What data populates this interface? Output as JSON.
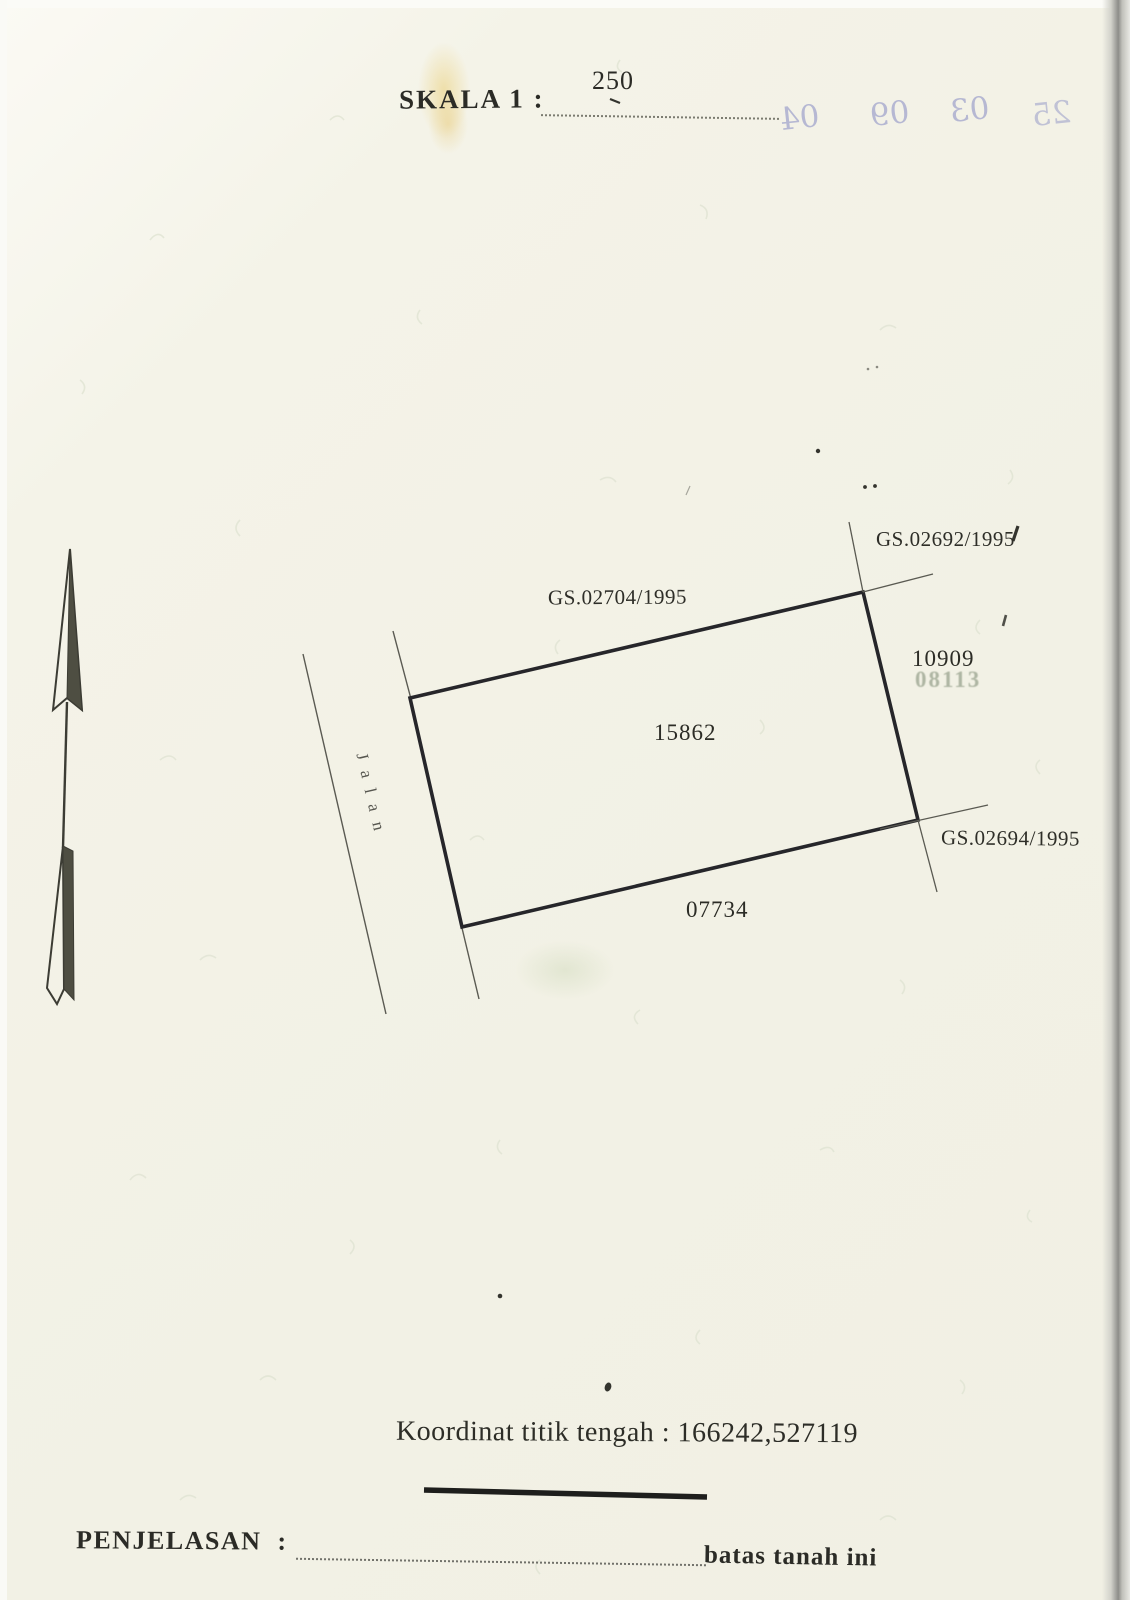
{
  "document": {
    "scale_label": "SKALA 1 :",
    "scale_value": "250",
    "bleedthrough_digits": [
      "04",
      "09",
      "03",
      "25"
    ],
    "road_label": "Jalan",
    "parcel": {
      "center_number": "15862",
      "north_boundary": "GS.02704/1995",
      "northeast_boundary": "GS.02692/1995",
      "east_number": "10909",
      "east_number_faint": "08113",
      "southeast_boundary": "GS.02694/1995",
      "south_number": "07734"
    },
    "footer": {
      "koordinat_label": "Koordinat titik tengah :",
      "koordinat_value": "166242,527119",
      "penjelasan_label": "PENJELASAN  :",
      "batas_label": "batas tanah ini"
    },
    "colors": {
      "paper": "#f2f1e5",
      "ink": "#2b2b26",
      "bleed_ink": "#8e93c6",
      "faint_stamp": "#98a28d"
    }
  }
}
